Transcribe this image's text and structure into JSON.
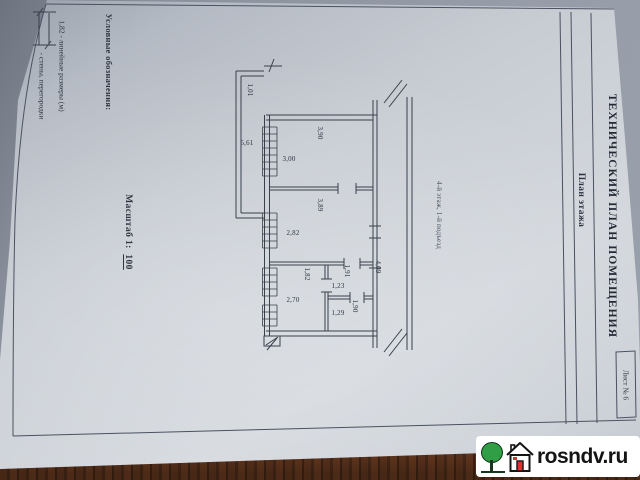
{
  "document": {
    "title_block": {
      "title": "ТЕХНИЧЕСКИЙ ПЛАН ПОМЕЩЕНИЯ",
      "subtitle": "План этажа",
      "sheet": "Лист № 6"
    },
    "legend": {
      "heading": "Условные обозначения:",
      "dimension_item": "1,82  -  линейные размеры (м)",
      "wall_item": "-  стены, перегородки"
    },
    "scale": {
      "label": "Масштаб 1:",
      "value": "100"
    },
    "plan": {
      "floor_note": "4-й этаж, 1-й подъезд",
      "dimensions": [
        "1,01",
        "5,61",
        "3,00",
        "3,90",
        "3,89",
        "2,82",
        "1,82",
        "2,70",
        "1,23",
        "1,91",
        "1,29",
        "1,90",
        "4,09"
      ]
    }
  },
  "watermark": {
    "text": "rosndv.ru",
    "icons": [
      "tree-icon",
      "house-icon"
    ],
    "colors": {
      "tree_green": "#2f9e44",
      "door_red": "#e03131",
      "background": "#ffffff"
    }
  },
  "photo": {
    "colors": {
      "paper": "#ccd1d8",
      "table_gray": "#8a919d",
      "wood_brown": "#6b3c22",
      "ink": "#39404c"
    }
  }
}
